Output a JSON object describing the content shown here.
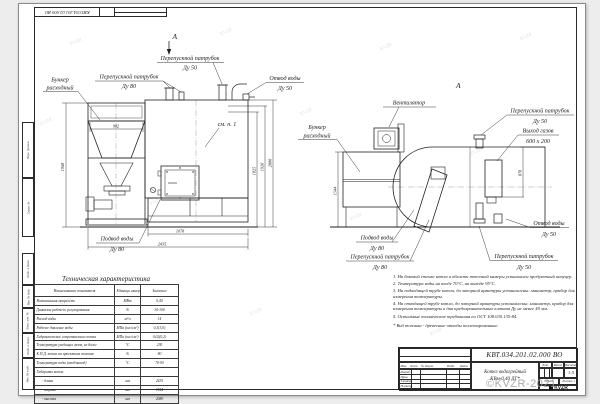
{
  "colors": {
    "ink": "#1b1b1b",
    "paper": "#ffffff",
    "watermark_gray": "#9b9b9b"
  },
  "watermark": {
    "corner": "©KVZR-2021",
    "tile": "KVZR"
  },
  "margin_columns": [
    "Перв. примен.",
    "Справ. №",
    "Подп. и дата",
    "Инв. № дубл.",
    "Взам. инв. №",
    "Подп. и дата",
    "Инв. № подл."
  ],
  "callouts": {
    "pp50": {
      "l1": "Перепускной патрубок",
      "l2": "Ду 50"
    },
    "pp80": {
      "l1": "Перепускной патрубок",
      "l2": "Ду 80"
    },
    "bunker": {
      "l1": "Бункер",
      "l2": "расходный"
    },
    "otvod50": {
      "l1": "Отвод воды",
      "l2": "Ду 50"
    },
    "podvod80": {
      "l1": "Подвод воды",
      "l2": "Ду 80"
    },
    "gas": {
      "l1": "Выход газов",
      "l2": "600 x 200"
    },
    "fan": "Вентилятор",
    "see_note": "см. п. 1",
    "view_letter": "А"
  },
  "dims": {
    "w902": "902",
    "h1968": "1968",
    "h1825": "1825",
    "h1920": "1920",
    "h2080": "2080",
    "w1078": "1078",
    "w2435": "2435",
    "h1544": "1544",
    "h878": "878"
  },
  "table": {
    "title": "Техническая характеристика",
    "headers": [
      "Наименование показателя",
      "Единица измерения",
      "Значение"
    ],
    "rows": [
      [
        "Номинальная мощность",
        "МВт",
        "0,40"
      ],
      [
        "Диапазон рабочего регулирования",
        "%",
        "30-100"
      ],
      [
        "Расход воды",
        "м³/ч",
        "14"
      ],
      [
        "Рабочее давление воды",
        "МПа (кгс/см²)",
        "0,3(3,0)"
      ],
      [
        "Гидравлическое сопротивление котла",
        "МПа (кгс/см²)",
        "0,02(0,2)"
      ],
      [
        "Температура уходящих газов, не более",
        "°С",
        "230"
      ],
      [
        "К.П.Д. котла на проектном топливе",
        "%",
        "80"
      ],
      [
        "Температура воды (вход/выход)",
        "°С",
        "70-95"
      ],
      [
        "Габариты котла",
        "",
        ""
      ],
      [
        "- длина",
        "мм",
        "2435"
      ],
      [
        "- ширина",
        "мм",
        "1544"
      ],
      [
        "- высота",
        "мм",
        "2080"
      ]
    ]
  },
  "notes": {
    "items": [
      "1. На боковой стенке котла в области топочной камеры установлен продувочный штуцер.",
      "2. Температура воды на входе 70°С, на выходе 95°С.",
      "3. На подводящей трубе котла, до запорной арматуры установлены: манометр, прибор для измерения температуры.",
      "4. На отводящей трубе котла, до запорной арматуры установлены: манометр, прибор для измерения температуры и два предохранительных клапана Ду не менее 40 мм.",
      "5. Остальные технические требования по ОСТ 108.030.135-84."
    ],
    "footnote": "* Вид топлива - древесные отходы пеллетированные."
  },
  "title_block": {
    "doc_number": "КВТ.034.201.02.000  ВО",
    "product_line1": "Котел водогрейный",
    "product_line2": "КВм-0,40  ДГ*",
    "col_headers": [
      "Изм.",
      "Лист",
      "№ докум.",
      "Подп.",
      "Дата"
    ],
    "row_labels": [
      "Разраб.",
      "Пров.",
      "Т.контр.",
      "Н.контр.",
      "Утв."
    ],
    "lit_label": "Лит.",
    "mass_label": "Масса",
    "scale_label": "Масштаб",
    "scale_value": "1:5",
    "sheet_label": "Лист",
    "sheets_label": "Листов 1",
    "logo_text": "KVZR"
  }
}
